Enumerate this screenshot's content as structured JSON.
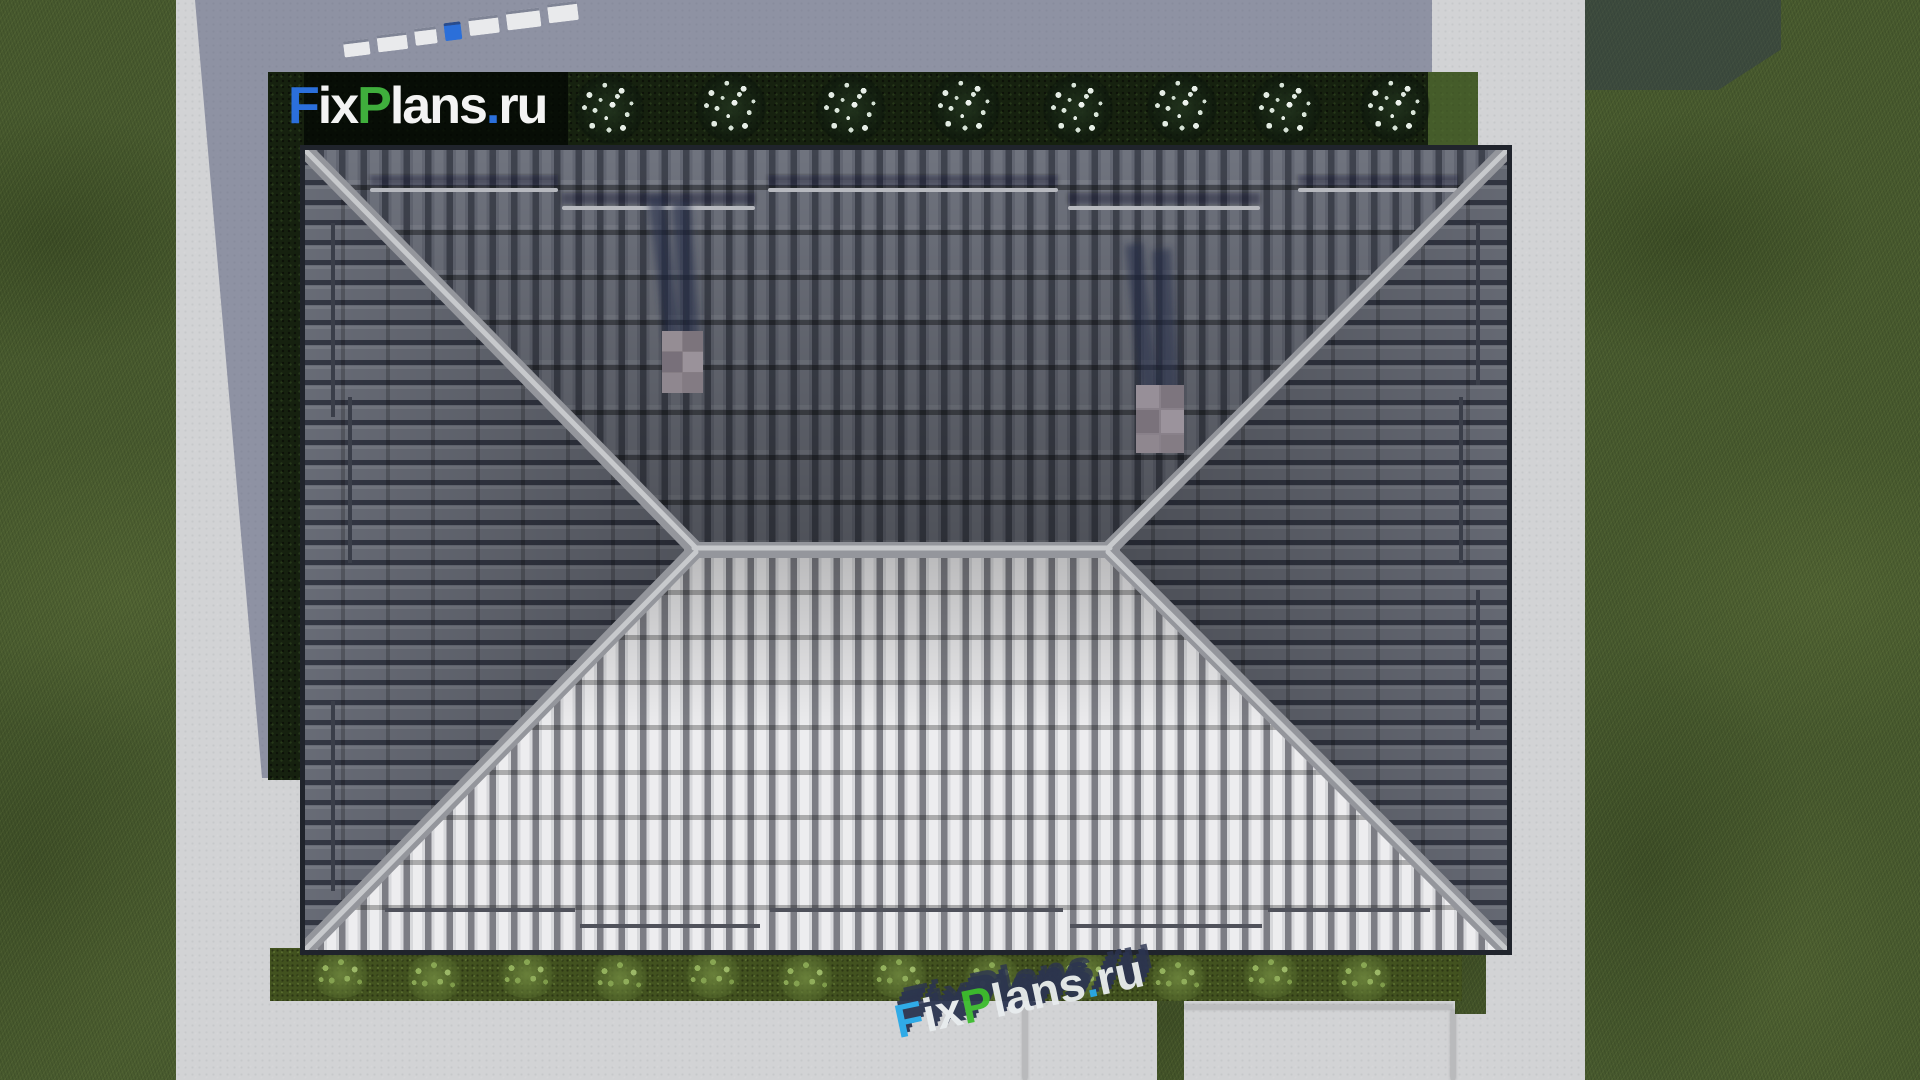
{
  "watermarks": {
    "main_logo": {
      "f": "F",
      "ix": "ix",
      "p": "P",
      "lans": "lans",
      "dot": ".",
      "ru": "ru",
      "full_text": "FixPlans.ru"
    },
    "bottom": {
      "f": "F",
      "ix": "ix",
      "p": "P",
      "lans": "lans",
      "dot": ".",
      "ru": "ru",
      "full_text": "FixPlans.ru"
    },
    "top_clipped": {
      "full_text": "FixPlans.ru (only letter bases visible at frame edge)"
    }
  },
  "scene_counts": {
    "flower_bushes_top_hedge": 8,
    "green_bushes_bottom_hedge": 12,
    "chimneys": 2,
    "roof_faces": 4
  },
  "colors": {
    "logo_blue": "#2b6fdb",
    "logo_green": "#3fae3c",
    "logo_white": "#f3f3f3",
    "watermark_navy": "#2b3450",
    "watermark_cyan": "#28a9e8",
    "watermark_green": "#3cbc2e",
    "roof_dark_tiles": "#565a67",
    "roof_light_tiles": "#dcdcde",
    "ridge_hip_cap": "#a3a5aa",
    "concrete_lit": "#d2d3d5",
    "cast_shadow": "#8e91a8",
    "grass": "#47592e",
    "hedge_dark": "#16210f",
    "hedge_bottom": "#42521f",
    "chimney_cap": "#8b838a"
  }
}
